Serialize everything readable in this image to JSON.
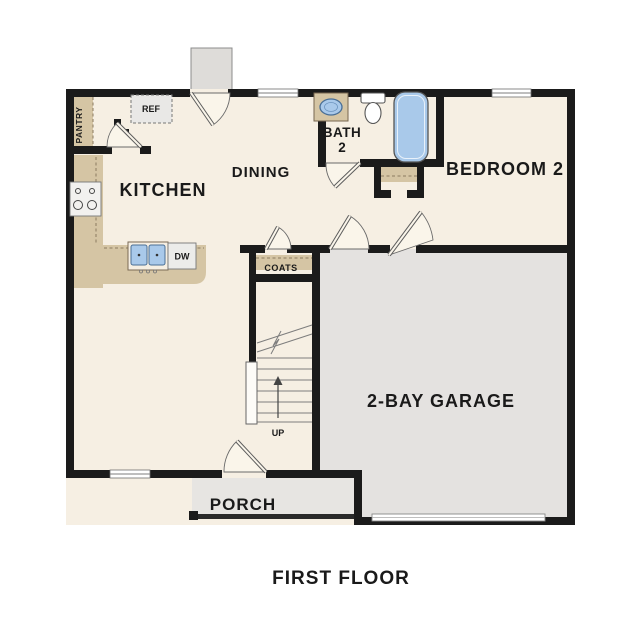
{
  "title": "FIRST FLOOR",
  "colors": {
    "wall": "#1b1b1b",
    "floor": "#f6efe3",
    "garage_floor": "#e4e2e0",
    "porch_floor": "#e7e5e2",
    "stoop": "#dedcd9",
    "cabinet_tan": "#d5c5a4",
    "dash_line": "#8a7a5f",
    "fixture_blue": "#a9c9ea",
    "fixture_blue_stroke": "#4a6f96",
    "appliance_gray": "#ececea",
    "text": "#1a1a1a"
  },
  "rooms": {
    "kitchen": {
      "label": "KITCHEN"
    },
    "dining": {
      "label": "DINING"
    },
    "bath": {
      "label_line1": "BATH",
      "label_line2": "2"
    },
    "bedroom2": {
      "label": "BEDROOM 2"
    },
    "garage": {
      "label": "2-BAY GARAGE"
    },
    "porch": {
      "label": "PORCH"
    },
    "pantry": {
      "label": "PANTRY"
    },
    "coats": {
      "label": "COATS"
    }
  },
  "fixtures": {
    "refrigerator": "REF",
    "dishwasher": "DW",
    "stairs_direction": "UP"
  }
}
